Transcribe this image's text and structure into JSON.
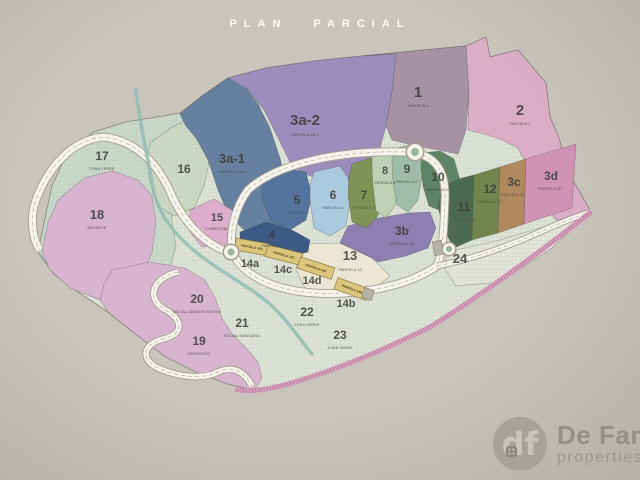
{
  "page": {
    "title": "PLAN PARCIAL",
    "background": "#c9c5bd"
  },
  "logo": {
    "monogram": "df",
    "name": "De Fari",
    "tagline": "properties",
    "circle_color": "#a7a29a",
    "text_color": "#95908a"
  },
  "map": {
    "outline": {
      "points": "38,252 52,186 68,152 94,132 126,122 158,117 180,113 202,96 228,78 266,68 314,61 362,56 424,50 466,46 486,37 490,57 518,50 546,83 550,117 559,138 567,170 591,212 540,252 480,296 430,327 380,352 330,372 288,384 255,390 228,384 196,372 166,357 138,336 108,312 78,292 54,274",
      "fill": "#dce2d6",
      "stroke": "#908b7e"
    },
    "parcels": [
      {
        "id": "17",
        "points": "38,252 52,186 68,152 94,132 126,122 158,117 180,113 188,132 182,155 174,175 170,198 172,222 176,246 170,268 152,288 128,306 100,300 76,290 54,272",
        "color": "#c9d8ca",
        "pattern": "grid",
        "label": {
          "text": "17",
          "x": 102,
          "y": 160,
          "size": 12
        },
        "caption": {
          "text": "ZONA VERDE",
          "x": 102,
          "y": 170
        }
      },
      {
        "id": "18",
        "points": "58,200 84,178 112,171 138,180 152,196 156,222 152,252 140,282 120,308 95,298 70,288 50,270 42,252 48,222",
        "color": "#d8b5cf",
        "label": {
          "text": "18",
          "x": 97,
          "y": 219,
          "size": 13
        },
        "caption": {
          "text": "DOCENTE",
          "x": 97,
          "y": 229
        }
      },
      {
        "id": "16",
        "points": "150,143 172,127 196,116 214,130 210,158 204,186 194,208 174,216 158,206 150,182 147,162",
        "color": "#cdd8c5",
        "pattern": "grid",
        "label": {
          "text": "16",
          "x": 184,
          "y": 173,
          "size": 12
        }
      },
      {
        "id": "3a-1",
        "points": "180,114 202,96 228,78 246,88 258,104 270,128 280,158 288,190 290,212 282,228 262,236 244,230 228,214 218,190 208,160 196,138 186,126",
        "color": "#67809f",
        "label": {
          "text": "3a-1",
          "x": 232,
          "y": 163,
          "size": 13
        },
        "caption": {
          "text": "PARCELA 3A-1",
          "x": 232,
          "y": 173
        }
      },
      {
        "id": "3a-2",
        "points": "228,78 266,68 314,61 362,56 396,54 392,92 386,126 378,156 368,174 340,182 310,176 292,166 280,142 264,110 248,90",
        "color": "#9c8ebc",
        "label": {
          "text": "3a-2",
          "x": 305,
          "y": 125,
          "size": 15
        },
        "caption": {
          "text": "PARCELA 3A-2",
          "x": 305,
          "y": 136
        }
      },
      {
        "id": "1",
        "points": "362,56 424,50 466,46 469,92 466,130 458,154 438,150 412,145 392,140 386,126 392,92 396,54",
        "color": "#a593a4",
        "label": {
          "text": "1",
          "x": 418,
          "y": 97,
          "size": 15
        },
        "caption": {
          "text": "PARCELA 1",
          "x": 418,
          "y": 107
        }
      },
      {
        "id": "2",
        "points": "466,46 486,37 490,57 518,50 546,83 550,117 559,138 567,170 591,212 556,220 538,196 528,168 518,148 502,140 484,134 468,130 469,92",
        "color": "#dbaec5",
        "label": {
          "text": "2",
          "x": 520,
          "y": 115,
          "size": 15
        },
        "caption": {
          "text": "PARCELA 2",
          "x": 520,
          "y": 125
        }
      },
      {
        "id": "zona-19-20-21",
        "points": "112,270 150,262 185,268 205,280 215,298 222,318 232,334 246,348 258,362 262,378 255,390 228,384 196,372 166,357 138,336 108,312 100,300 104,284",
        "color": "#d8b5cf"
      },
      {
        "id": "15",
        "points": "190,210 214,199 232,210 236,230 224,246 202,247 190,232",
        "color": "#dcaecb",
        "label": {
          "text": "15",
          "x": 217,
          "y": 221,
          "size": 11
        },
        "caption": {
          "text": "COMERCIAL",
          "x": 217,
          "y": 230
        }
      },
      {
        "id": "13",
        "points": "302,244 340,243 372,258 390,276 372,290 338,296 306,290 296,270 298,254",
        "color": "#ebe7d4",
        "label": {
          "text": "13",
          "x": 350,
          "y": 260,
          "size": 13
        },
        "caption": {
          "text": "PARCELA 13",
          "x": 350,
          "y": 271
        }
      },
      {
        "id": "3b",
        "points": "344,234 348,226 378,218 408,213 430,212 436,228 428,248 406,256 378,262 372,258 340,243",
        "color": "#8d7fb0",
        "label": {
          "text": "3b",
          "x": 402,
          "y": 235,
          "size": 12
        },
        "caption": {
          "text": "PARCELA 3B",
          "x": 402,
          "y": 245
        }
      },
      {
        "id": "5",
        "points": "262,176 286,168 306,172 312,196 306,220 290,230 272,222 262,200",
        "color": "#54749e",
        "label": {
          "text": "5",
          "x": 297,
          "y": 204,
          "size": 12
        },
        "caption": {
          "text": "PARCELA 5",
          "x": 297,
          "y": 214
        }
      },
      {
        "id": "4",
        "points": "240,232 266,222 292,230 310,240 308,252 282,258 256,254 240,244",
        "color": "#3d5a84",
        "label": {
          "text": "4",
          "x": 272,
          "y": 238,
          "size": 11
        },
        "caption": {
          "text": "PARCELA 4",
          "x": 272,
          "y": 247
        }
      },
      {
        "id": "6",
        "points": "314,172 340,166 348,178 350,202 346,226 330,236 314,228 310,200 310,184",
        "color": "#accadd",
        "label": {
          "text": "6",
          "x": 333,
          "y": 199,
          "size": 12
        },
        "caption": {
          "text": "PARCELA 6",
          "x": 333,
          "y": 209
        }
      },
      {
        "id": "7",
        "points": "352,164 370,158 380,166 382,192 378,216 366,228 352,222 348,196 349,178",
        "color": "#7e9355",
        "label": {
          "text": "7",
          "x": 364,
          "y": 199,
          "size": 12
        },
        "caption": {
          "text": "PARCELA 7",
          "x": 364,
          "y": 209
        }
      },
      {
        "id": "8",
        "points": "372,156 390,150 397,159 399,182 395,206 386,218 376,211 373,186 372,168",
        "color": "#bed1b5",
        "label": {
          "text": "8",
          "x": 385,
          "y": 174,
          "size": 11
        },
        "caption": {
          "text": "PARCELA 8",
          "x": 385,
          "y": 184
        }
      },
      {
        "id": "9",
        "points": "392,149 410,145 420,153 422,176 418,200 408,212 397,205 393,181 392,163",
        "color": "#9fbcaa",
        "label": {
          "text": "9",
          "x": 407,
          "y": 173,
          "size": 12
        },
        "caption": {
          "text": "PARCELA 9",
          "x": 407,
          "y": 183
        }
      },
      {
        "id": "10",
        "points": "422,153 440,151 454,159 460,180 456,200 444,212 429,206 423,186 421,168",
        "color": "#5e8465",
        "label": {
          "text": "10",
          "x": 438,
          "y": 181,
          "size": 12
        },
        "caption": {
          "text": "PARCELA 10",
          "x": 438,
          "y": 191
        }
      },
      {
        "id": "11",
        "points": "443,186 462,178 474,175 472,240 454,248 442,226 438,205",
        "color": "#4c6b4e",
        "label": {
          "text": "11",
          "x": 464,
          "y": 211,
          "size": 12
        },
        "caption": {
          "text": "PARCELA 11",
          "x": 464,
          "y": 221
        }
      },
      {
        "id": "12",
        "points": "474,175 500,167 498,233 472,240",
        "color": "#73854e",
        "label": {
          "text": "12",
          "x": 490,
          "y": 193,
          "size": 12
        },
        "caption": {
          "text": "PARCELA 12",
          "x": 490,
          "y": 203
        }
      },
      {
        "id": "3c",
        "points": "500,167 526,159 524,224 498,233",
        "color": "#b08a5e",
        "label": {
          "text": "3c",
          "x": 514,
          "y": 186,
          "size": 12
        },
        "caption": {
          "text": "PARCELA 3C",
          "x": 513,
          "y": 196
        }
      },
      {
        "id": "3d",
        "points": "526,159 556,150 576,144 572,208 524,224",
        "color": "#d193b3",
        "label": {
          "text": "3d",
          "x": 551,
          "y": 180,
          "size": 12
        },
        "caption": {
          "text": "PARCELA 3D",
          "x": 550,
          "y": 190
        }
      },
      {
        "id": "24",
        "points": "448,252 500,240 560,222 590,212 552,248 500,282 456,286 444,268",
        "color": "#e3e4da",
        "pattern": "grid",
        "label": {
          "text": "24",
          "x": 460,
          "y": 263,
          "size": 13
        }
      },
      {
        "id": "20",
        "label": {
          "text": "20",
          "x": 197,
          "y": 303,
          "size": 12
        },
        "caption": {
          "text": "SOCIAL ADMINISTRATIVO",
          "x": 197,
          "y": 313
        }
      },
      {
        "id": "21",
        "label": {
          "text": "21",
          "x": 242,
          "y": 327,
          "size": 12
        },
        "caption": {
          "text": "SOCIAL SANITARIO",
          "x": 242,
          "y": 337
        }
      },
      {
        "id": "19",
        "label": {
          "text": "19",
          "x": 199,
          "y": 345,
          "size": 12
        },
        "caption": {
          "text": "DEPORTIVO",
          "x": 199,
          "y": 355
        }
      },
      {
        "id": "22",
        "label": {
          "text": "22",
          "x": 307,
          "y": 316,
          "size": 12
        },
        "caption": {
          "text": "ZONA VERDE",
          "x": 307,
          "y": 326
        }
      },
      {
        "id": "23",
        "label": {
          "text": "23",
          "x": 340,
          "y": 339,
          "size": 12
        },
        "caption": {
          "text": "ZONA VERDE",
          "x": 340,
          "y": 349
        }
      },
      {
        "id": "14a",
        "label": {
          "text": "14a",
          "x": 250,
          "y": 267,
          "size": 11
        }
      },
      {
        "id": "14c",
        "label": {
          "text": "14c",
          "x": 283,
          "y": 273,
          "size": 11
        }
      },
      {
        "id": "14d",
        "label": {
          "text": "14d",
          "x": 312,
          "y": 284,
          "size": 11
        }
      },
      {
        "id": "14b",
        "label": {
          "text": "14b",
          "x": 346,
          "y": 307,
          "size": 11
        }
      }
    ],
    "roads": [
      {
        "id": "loop-road",
        "d": "M248,190 C278,162 344,150 408,152 C436,154 446,172 445,198 C444,228 443,252 437,266 C402,290 342,298 296,291 C262,285 240,270 233,253 C228,232 236,206 248,190 Z",
        "w": 7
      },
      {
        "id": "west-road",
        "d": "M233,253 C205,247 183,220 172,196 C158,162 134,140 103,137 C72,140 46,168 34,206 C30,225 34,242 40,250",
        "w": 7
      },
      {
        "id": "south-road",
        "d": "M178,272 C152,278 146,298 164,309 C184,320 184,334 163,339 C143,344 139,360 160,369 C182,378 204,379 218,372 C236,364 246,375 252,386",
        "w": 5.5
      },
      {
        "id": "east-road",
        "d": "M437,266 C468,260 505,248 540,232 C562,222 578,216 591,212",
        "w": 5
      }
    ],
    "stream": {
      "d": "M136,90 C140,125 148,158 153,188 C158,215 177,238 202,257 C228,276 256,291 272,306 C289,322 300,340 312,354",
      "color": "#93bcb4",
      "w": 3.5
    },
    "strip": {
      "d": "M591,212 C540,252 480,296 430,327 C380,352 330,372 288,384 C262,391 245,392 235,389",
      "color": "#d49fba",
      "hatch": "#bf7ea2",
      "w": 5
    },
    "blocks": [
      {
        "cx": 252,
        "cy": 247,
        "w": 34,
        "h": 12,
        "rot": 10,
        "color": "#dbc67e",
        "border": "#8a7a40",
        "text": "PARCELA 14A"
      },
      {
        "cx": 284,
        "cy": 255,
        "w": 36,
        "h": 12,
        "rot": 14,
        "color": "#dbc67e",
        "border": "#8a7a40",
        "text": "PARCELA 14C"
      },
      {
        "cx": 316,
        "cy": 268,
        "w": 36,
        "h": 12,
        "rot": 18,
        "color": "#dbc67e",
        "border": "#8a7a40",
        "text": "PARCELA 14D"
      },
      {
        "cx": 352,
        "cy": 289,
        "w": 34,
        "h": 12,
        "rot": 20,
        "color": "#dbc67e",
        "border": "#8a7a40",
        "text": "PARCELA 14B"
      },
      {
        "cx": 368,
        "cy": 294,
        "w": 10,
        "h": 10,
        "rot": 20,
        "color": "#b5b2a8",
        "border": "#8d887b",
        "text": ""
      },
      {
        "cx": 438,
        "cy": 248,
        "w": 9,
        "h": 14,
        "rot": -10,
        "color": "#b5b2a8",
        "border": "#8d887b",
        "text": ""
      }
    ],
    "roundabouts": [
      {
        "x": 415,
        "y": 152,
        "r": 8
      },
      {
        "x": 231,
        "y": 252,
        "r": 7
      },
      {
        "x": 449,
        "y": 249,
        "r": 6
      }
    ],
    "label_color": "#3a3a3a",
    "caption_color": "#44443f",
    "road_fill": "#f5f3ec",
    "road_casing": "#a39e90"
  }
}
